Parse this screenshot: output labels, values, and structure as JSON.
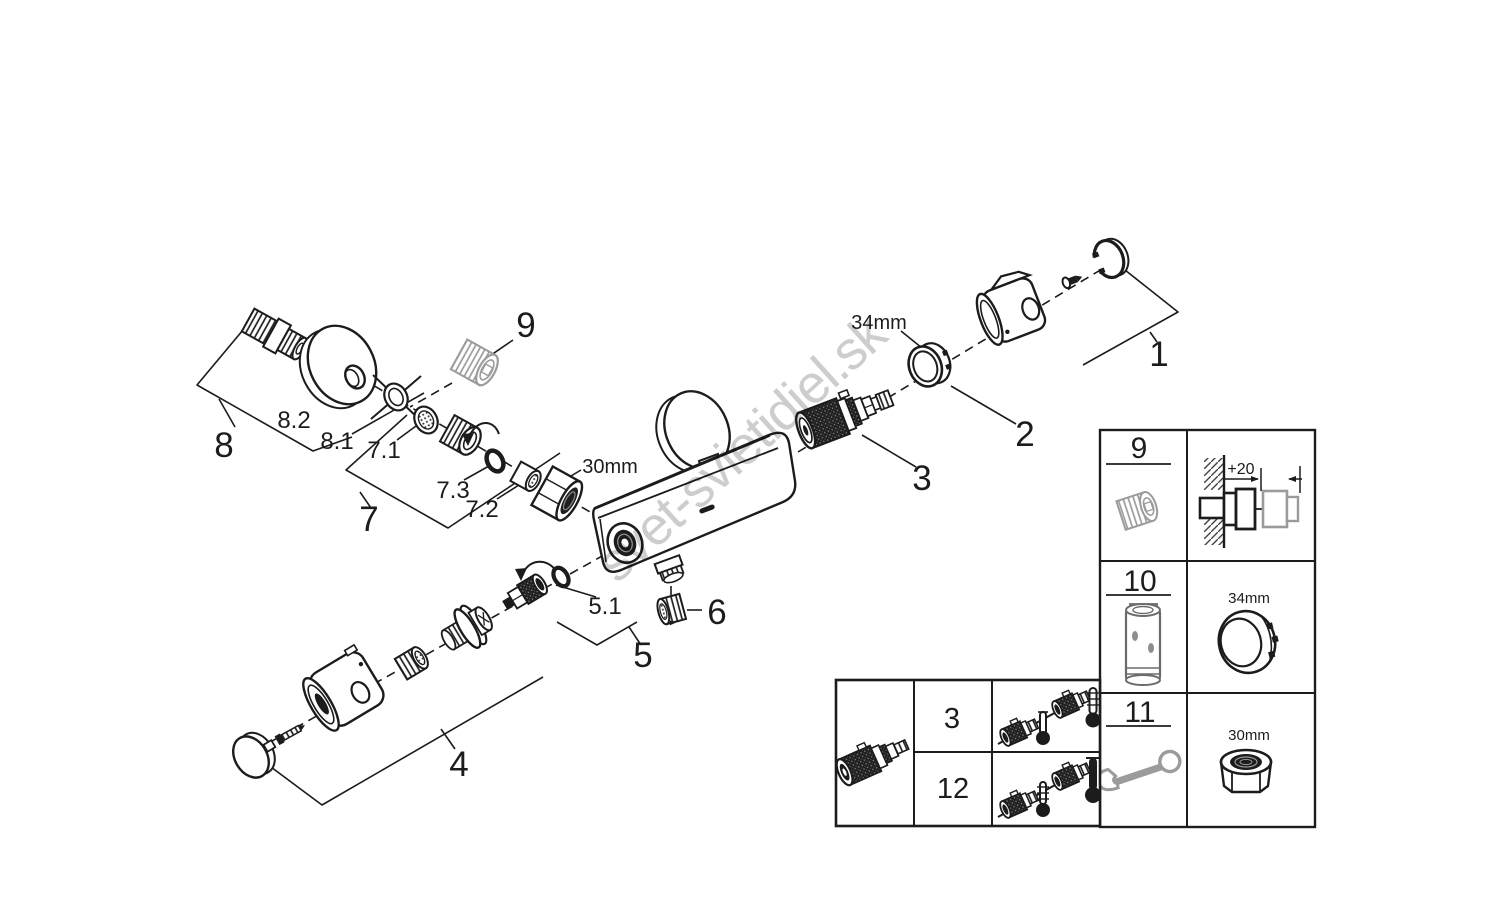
{
  "watermark": {
    "text": "svet-svietidiel.sk"
  },
  "colors": {
    "ink": "#1c1c1c",
    "gray_part": "#9b9b9b",
    "watermark": "#c9c9c9",
    "background": "#ffffff"
  },
  "callouts": {
    "p1": "1",
    "p2": "2",
    "p3": "3",
    "p4": "4",
    "p5": "5",
    "p5_1": "5.1",
    "p6": "6",
    "p7": "7",
    "p7_1": "7.1",
    "p7_2": "7.2",
    "p7_3": "7.3",
    "p8": "8",
    "p8_1": "8.1",
    "p8_2": "8.2",
    "p9": "9"
  },
  "dimensions": {
    "nut": "30mm",
    "ring": "34mm"
  },
  "service_table": {
    "rows": [
      {
        "ref": "9",
        "icon": "wall-extension-adapter-icon",
        "detail_label": "+20",
        "detail_icon": "extension-install-diagram"
      },
      {
        "ref": "10",
        "icon": "extension-sleeve-icon",
        "detail_label": "34mm",
        "detail_icon": "locking-collar-icon"
      },
      {
        "ref": "11",
        "icon": "open-end-wrench-icon",
        "detail_label": "30mm",
        "detail_icon": "hex-union-nut-icon"
      }
    ]
  },
  "cartridge_table": {
    "icon": "thermostatic-cartridge-icon",
    "rows": [
      {
        "ref": "3",
        "icon": "cartridge-thermometer-orientation-a"
      },
      {
        "ref": "12",
        "icon": "cartridge-thermometer-orientation-b"
      }
    ]
  }
}
